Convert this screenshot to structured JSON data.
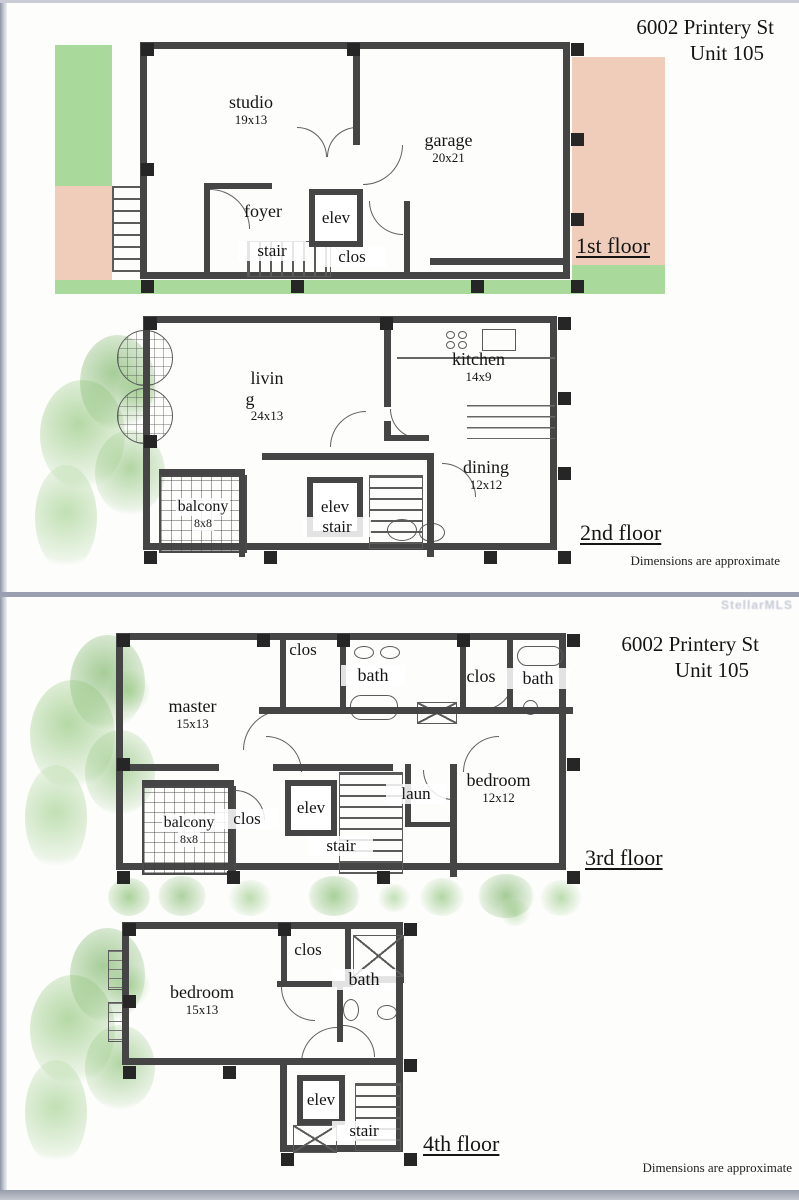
{
  "title": {
    "line1": "6002 Printery St",
    "line2": "Unit 105"
  },
  "footer": {
    "note": "Dimensions are approximate"
  },
  "watermark": "StellarMLS",
  "colors": {
    "green": "#a9d99b",
    "salmon": "#efcdba",
    "wall": "#454545",
    "divider": "#9aa0b0"
  },
  "floor1": {
    "label": "1st floor",
    "studio": {
      "name": "studio",
      "dims": "19x13"
    },
    "garage": {
      "name": "garage",
      "dims": "20x21"
    },
    "foyer": "foyer",
    "elev": "elev",
    "stair": "stair",
    "clos": "clos"
  },
  "floor2": {
    "label": "2nd floor",
    "living": {
      "line1": "livin",
      "line2": "g",
      "dims": "24x13"
    },
    "kitchen": {
      "name": "kitchen",
      "dims": "14x9"
    },
    "dining": {
      "name": "dining",
      "dims": "12x12"
    },
    "balcony": {
      "name": "balcony",
      "dims": "8x8"
    },
    "elev": "elev",
    "stair": "stair"
  },
  "floor3": {
    "label": "3rd floor",
    "master": {
      "name": "master",
      "dims": "15x13"
    },
    "clos_top": "clos",
    "bath1": "bath",
    "clos_right": "clos",
    "bath2": "bath",
    "bedroom": {
      "name": "bedroom",
      "dims": "12x12"
    },
    "balcony": {
      "name": "balcony",
      "dims": "8x8"
    },
    "clos_mid": "clos",
    "elev": "elev",
    "laun": "laun",
    "stair": "stair"
  },
  "floor4": {
    "label": "4th floor",
    "bedroom": {
      "name": "bedroom",
      "dims": "15x13"
    },
    "clos": "clos",
    "bath": "bath",
    "elev": "elev",
    "stair": "stair"
  }
}
